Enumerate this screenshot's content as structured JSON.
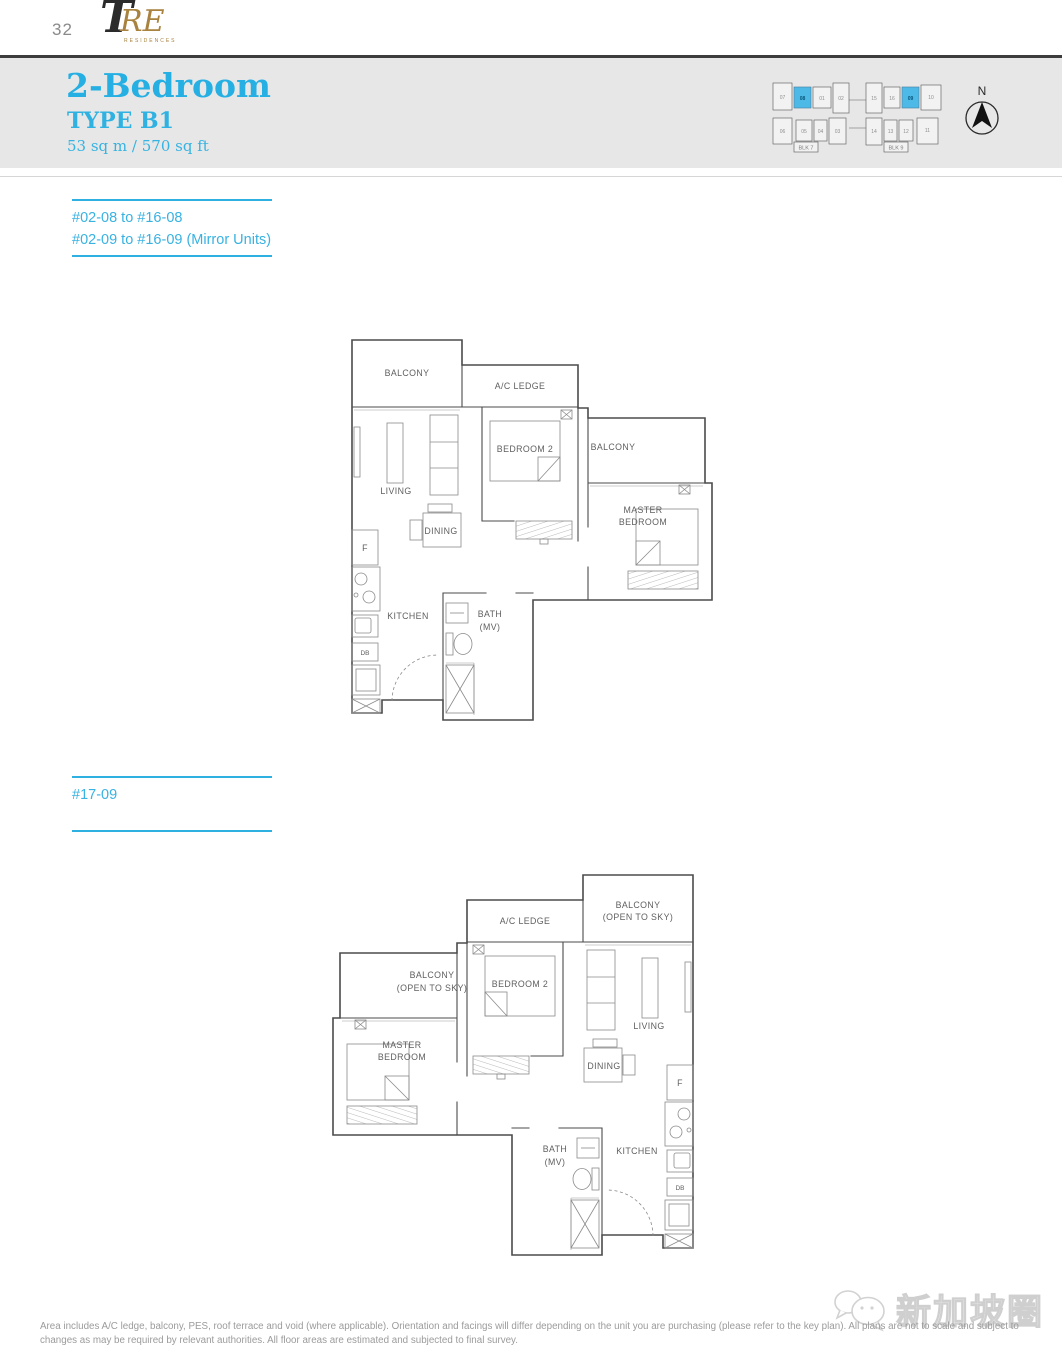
{
  "page": {
    "number": "32"
  },
  "logo": {
    "t": "T",
    "re": "RE",
    "sub": "RESIDENCES"
  },
  "header": {
    "title": "2-Bedroom",
    "type": "TYPE B1",
    "area": "53 sq m / 570 sq ft"
  },
  "colors": {
    "accent": "#2eb0e0",
    "keyplan_highlight": "#4cb9e6"
  },
  "stack1": {
    "line1": "#02-08 to #16-08",
    "line2": "#02-09 to #16-09 (Mirror Units)"
  },
  "stack2": {
    "line1": "#17-09"
  },
  "keyplan": {
    "north_label": "N",
    "blocks": [
      {
        "name": "BLK 7",
        "units_top": [
          "07",
          "08",
          "01",
          "02"
        ],
        "units_bottom": [
          "06",
          "05",
          "04",
          "03"
        ],
        "highlighted_unit": "08"
      },
      {
        "name": "BLK 9",
        "units_top": [
          "15",
          "16",
          "09",
          "10"
        ],
        "units_bottom": [
          "14",
          "13",
          "12",
          "11"
        ],
        "highlighted_unit": "09"
      }
    ]
  },
  "plan1": {
    "labels": {
      "balcony_top": "BALCONY",
      "ac_ledge": "A/C LEDGE",
      "bedroom2": "BEDROOM 2",
      "balcony_right": "BALCONY",
      "living": "LIVING",
      "dining": "DINING",
      "master_line1": "MASTER",
      "master_line2": "BEDROOM",
      "fridge": "F",
      "kitchen": "KITCHEN",
      "bath_line1": "BATH",
      "bath_line2": "(MV)",
      "db": "DB"
    }
  },
  "plan2": {
    "labels": {
      "ac_ledge": "A/C LEDGE",
      "balcony_right_line1": "BALCONY",
      "balcony_right_line2": "(OPEN TO SKY)",
      "balcony_left_line1": "BALCONY",
      "balcony_left_line2": "(OPEN TO SKY)",
      "bedroom2": "BEDROOM 2",
      "living": "LIVING",
      "dining": "DINING",
      "master_line1": "MASTER",
      "master_line2": "BEDROOM",
      "fridge": "F",
      "kitchen": "KITCHEN",
      "bath_line1": "BATH",
      "bath_line2": "(MV)",
      "db": "DB"
    }
  },
  "watermark": {
    "text": "新加坡圈"
  },
  "footer": {
    "disclaimer": "Area includes A/C ledge, balcony, PES, roof terrace and void (where applicable). Orientation and facings will differ depending on the unit you are purchasing (please refer to the key plan). All plans are not to scale and subject to changes as may be required by relevant authorities. All floor areas are estimated and subjected to final survey."
  }
}
